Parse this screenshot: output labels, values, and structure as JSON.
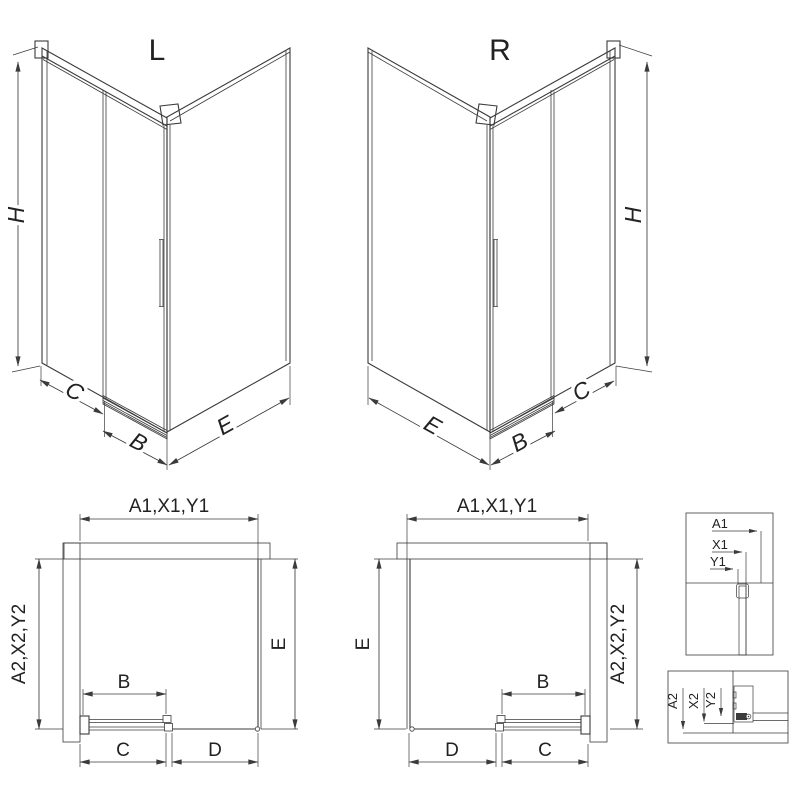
{
  "colors": {
    "line": "#3b3b3b",
    "ink": "#222222",
    "paper": "#ffffff",
    "hatch": "#555555"
  },
  "iso_left": {
    "title": "L",
    "dim_height": "H",
    "dim_c": "C",
    "dim_b": "B",
    "dim_e": "E"
  },
  "iso_right": {
    "title": "R",
    "dim_height": "H",
    "dim_c": "C",
    "dim_b": "B",
    "dim_e": "E"
  },
  "plan_left": {
    "dim_a1": "A1,X1,Y1",
    "dim_a2": "A2,X2,Y2",
    "dim_e": "E",
    "dim_b": "B",
    "dim_c": "C",
    "dim_d": "D"
  },
  "plan_right": {
    "dim_a1": "A1,X1,Y1",
    "dim_a2": "A2,X2,Y2",
    "dim_e": "E",
    "dim_b": "B",
    "dim_c": "C",
    "dim_d": "D"
  },
  "detail_top": {
    "row1": "A1",
    "row2": "X1",
    "row3": "Y1"
  },
  "detail_bottom": {
    "row1": "A2",
    "row2": "X2",
    "row3": "Y2"
  }
}
